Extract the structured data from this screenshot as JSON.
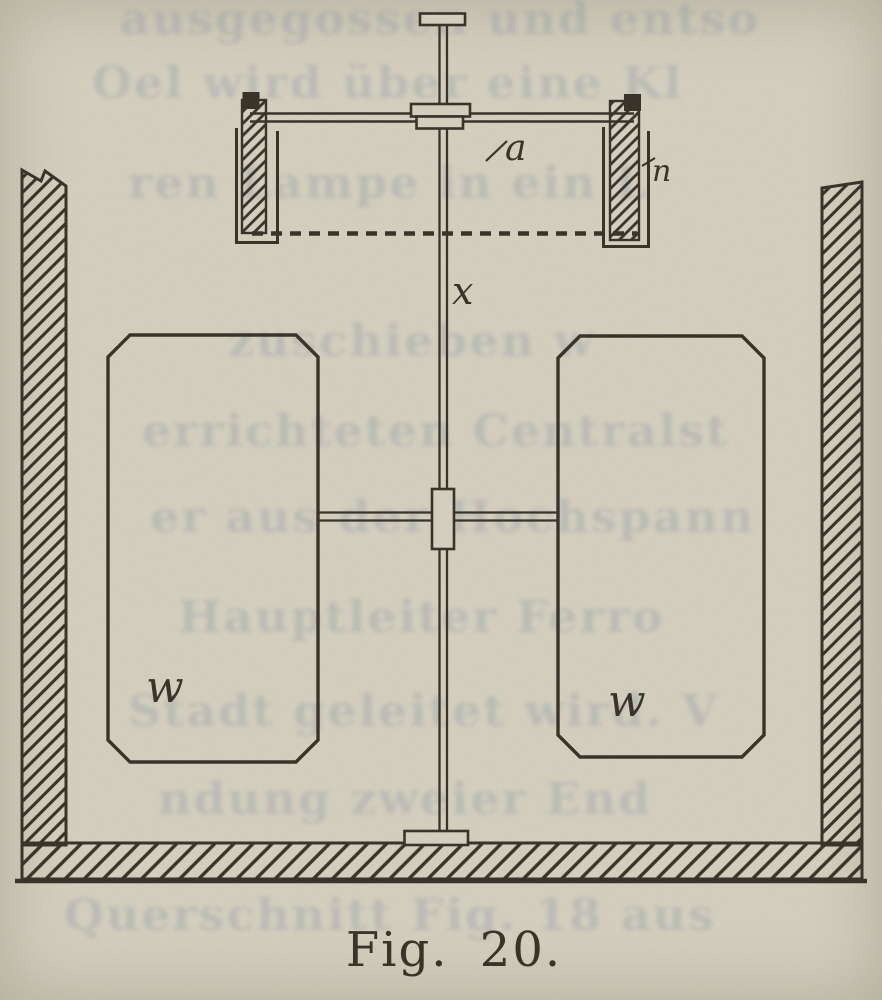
{
  "page": {
    "caption": "Fig. 20."
  },
  "figure": {
    "type": "technical-illustration-vessel-with-stirrer",
    "labels": {
      "arm": "a",
      "post": "n",
      "shaft": "x",
      "left_block": "w",
      "right_block": "w"
    }
  },
  "colors": {
    "paper": "#d7d2c2",
    "ink": "#3b342b",
    "ghost_text": "#8d9aa8"
  },
  "ghost_text_lines": [
    {
      "text": "ausgegossen und entso"
    },
    {
      "text": "Oel wird über eine Kl"
    },
    {
      "text": "ren Lampe in ein L"
    },
    {
      "text": "zuschieben w"
    },
    {
      "text": "errichteten Centralst"
    },
    {
      "text": "er aus der Hochspann"
    },
    {
      "text": "Hauptleiter Ferro"
    },
    {
      "text": "Stadt geleitet wird. V"
    },
    {
      "text": "ndung zweier End"
    },
    {
      "text": "Querschnitt Fig. 18 aus"
    }
  ]
}
